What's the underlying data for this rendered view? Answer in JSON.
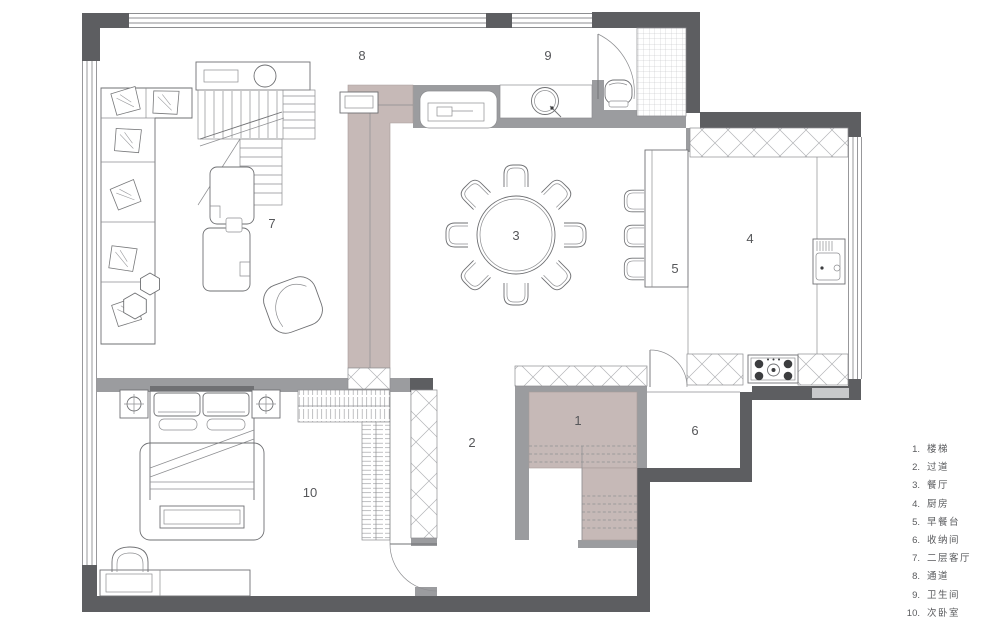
{
  "colors": {
    "wall_dark": "#5d5e61",
    "wall_mid": "#9b9c9f",
    "wall_light": "#c8c9cb",
    "accent_pink": "#c6b9b7",
    "line": "#6f7073",
    "text": "#56575a",
    "bg": "#ffffff"
  },
  "plan": {
    "rooms": {
      "r1": {
        "num": "1",
        "name": "楼梯"
      },
      "r2": {
        "num": "2",
        "name": "过道"
      },
      "r3": {
        "num": "3",
        "name": "餐厅"
      },
      "r4": {
        "num": "4",
        "name": "厨房"
      },
      "r5": {
        "num": "5",
        "name": "早餐台"
      },
      "r6": {
        "num": "6",
        "name": "收纳间"
      },
      "r7": {
        "num": "7",
        "name": "二层客厅"
      },
      "r8": {
        "num": "8",
        "name": "通道"
      },
      "r9": {
        "num": "9",
        "name": "卫生间"
      },
      "r10": {
        "num": "10",
        "name": "次卧室"
      }
    }
  },
  "legend": {
    "items": [
      {
        "num": "1.",
        "label": "楼梯"
      },
      {
        "num": "2.",
        "label": "过道"
      },
      {
        "num": "3.",
        "label": "餐厅"
      },
      {
        "num": "4.",
        "label": "厨房"
      },
      {
        "num": "5.",
        "label": "早餐台"
      },
      {
        "num": "6.",
        "label": "收纳间"
      },
      {
        "num": "7.",
        "label": "二层客厅"
      },
      {
        "num": "8.",
        "label": "通道"
      },
      {
        "num": "9.",
        "label": "卫生间"
      },
      {
        "num": "10.",
        "label": "次卧室"
      }
    ]
  }
}
